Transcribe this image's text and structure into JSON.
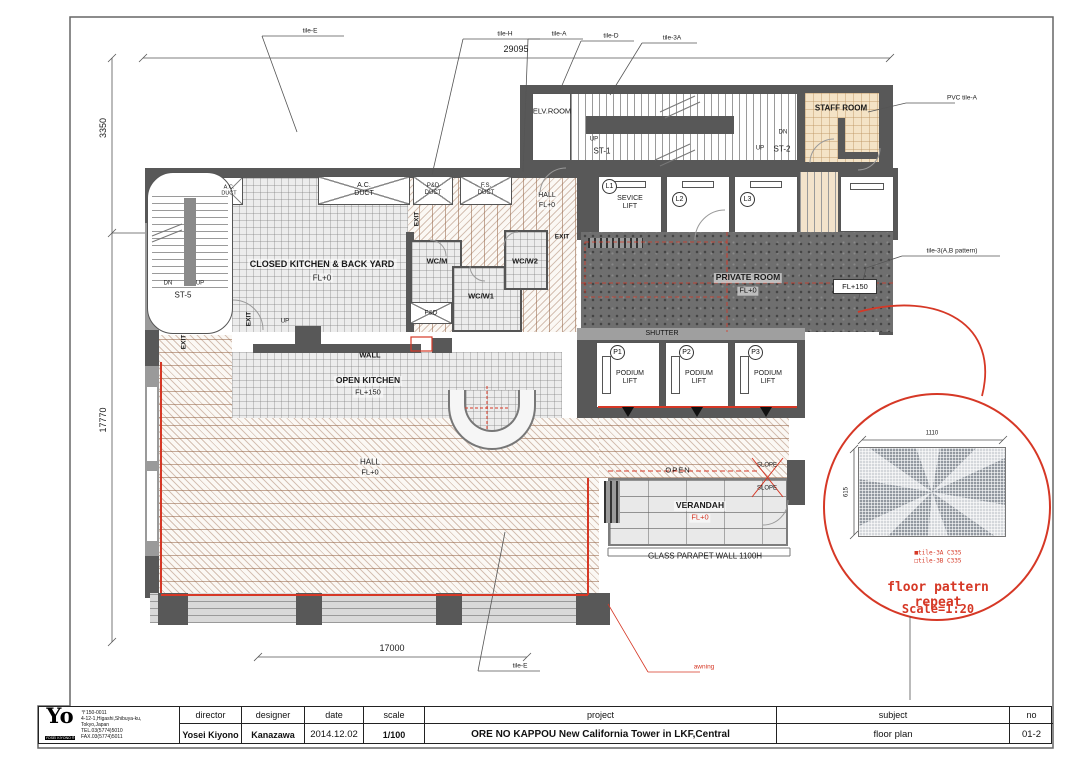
{
  "sheet": {
    "logo_main": "Yo",
    "logo_sub": "YOSEI KIYONO ®",
    "address": {
      "postal": "〒150-0011",
      "line1": "4-12-1,Higashi,Shibuya-ku,",
      "line2": "Tokyo,Japan",
      "tel": "TEL.03(5774)5010",
      "fax": "FAX.03(5774)5011"
    },
    "titleblock": {
      "cols": [
        {
          "label": "director",
          "value": "Yosei Kiyono"
        },
        {
          "label": "designer",
          "value": "Kanazawa"
        },
        {
          "label": "date",
          "value": "2014.12.02"
        },
        {
          "label": "scale",
          "value": "1/100"
        },
        {
          "label": "project",
          "value": "ORE NO KAPPOU   New California Tower in LKF,Central"
        },
        {
          "label": "subject",
          "value": "floor plan"
        },
        {
          "label": "no",
          "value": "01-2"
        }
      ]
    }
  },
  "dimensions": {
    "top": "29095",
    "left_upper": "3350",
    "left_main": "17770",
    "bottom": "17000"
  },
  "callouts": {
    "top": [
      "tile-E",
      "tile-H",
      "tile-A",
      "tile-D",
      "tile-3A"
    ],
    "right_upper": "PVC tile-A",
    "right_mid": "tile-3(A,B pattern)",
    "bottom_tile": "tile-E",
    "bottom_awning": "awning"
  },
  "labels": {
    "elv_room": "ELV.ROOM",
    "st1": "ST-1",
    "st2": "ST-2",
    "st5": "ST-5",
    "up": "UP",
    "dn": "DN",
    "exit": "EXIT",
    "staff_room": "STAFF ROOM",
    "ac_duct": "A.C.\nDUCT",
    "pd_duct": "P&D\nDUCT",
    "fs_duct": "F.S.\nDUCT",
    "hall": "HALL",
    "fl0": "FL+0",
    "fl150": "FL+150",
    "closed_kitchen": "CLOSED KITCHEN & BACK YARD",
    "open_kitchen": "OPEN KITCHEN",
    "private_room": "PRIVATE ROOM",
    "wcm": "WC/M",
    "wcw1": "WC/W1",
    "wcw2": "WC/W2",
    "fd": "F&D",
    "wall": "WALL",
    "shutter": "SHUTTER",
    "l1": "L1",
    "l2": "L2",
    "l3": "L3",
    "sevice_lift": "SEVICE\nLIFT",
    "p1": "P1",
    "p2": "P2",
    "p3": "P3",
    "podium_lift": "PODIUM\nLIFT",
    "open": "OPEN",
    "slope": "SLOPE",
    "verandah": "VERANDAH",
    "parapet": "GLASS PARAPET WALL 1100H"
  },
  "detail": {
    "dim_w": "1110",
    "dim_h": "615",
    "legend_a": "■tile-3A C335",
    "legend_b": "□tile-3B C335",
    "title": "floor pattern repeat",
    "scale": "Scale=1:20"
  },
  "colors": {
    "accent_red": "#d63826",
    "wall_dark": "#585858",
    "staff_beige": "#f4e3c6"
  }
}
